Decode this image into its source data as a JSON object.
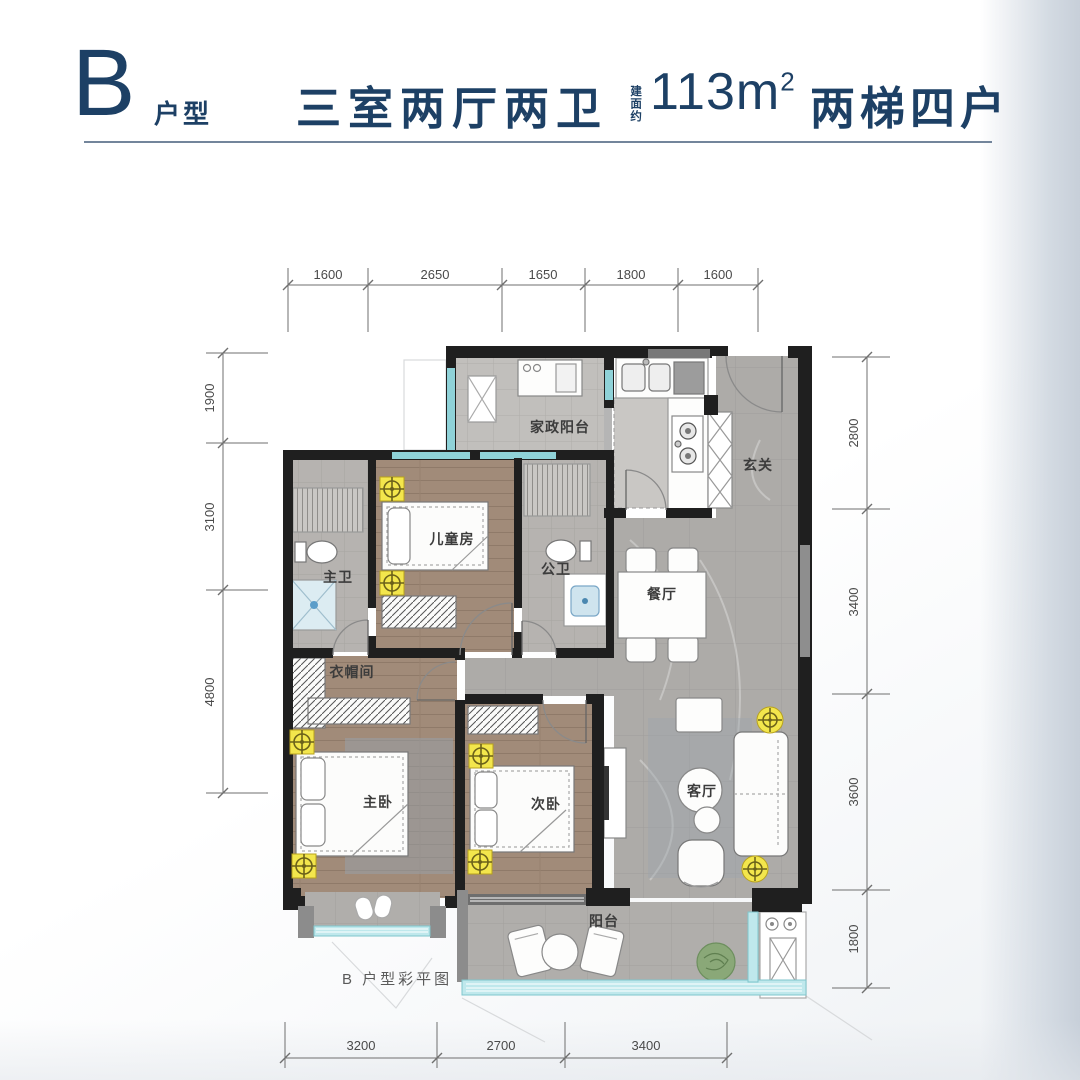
{
  "header": {
    "unit_letter": "B",
    "unit_type_label": "户型",
    "title": "三室两厅两卫",
    "area_prefix": "建面约",
    "area_value": "113m",
    "area_superscript": "2",
    "layout_info": "两梯四户"
  },
  "caption": "B 户型彩平图",
  "rooms": {
    "utility_balcony": "家政阳台",
    "entry": "玄关",
    "kids_room": "儿童房",
    "master_bath": "主卫",
    "public_bath": "公卫",
    "dining": "餐厅",
    "cloakroom": "衣帽间",
    "master_bedroom": "主卧",
    "second_bedroom": "次卧",
    "living_room": "客厅",
    "balcony": "阳台"
  },
  "dimensions": {
    "top": [
      "1600",
      "2650",
      "1650",
      "1800",
      "1600"
    ],
    "left": [
      "1900",
      "3100",
      "4800"
    ],
    "right": [
      "2800",
      "3400",
      "3600",
      "1800"
    ],
    "bottom": [
      "3200",
      "2700",
      "3400"
    ]
  },
  "colors": {
    "accent_navy": "#1d4065",
    "wall_black": "#1f1f1f",
    "window_teal": "#8fd2d8",
    "light_yellow": "#f3e64c",
    "wood_floor": "#a18b79",
    "marble_floor": "#adaba8",
    "bath_tile": "#b6b3b0"
  }
}
